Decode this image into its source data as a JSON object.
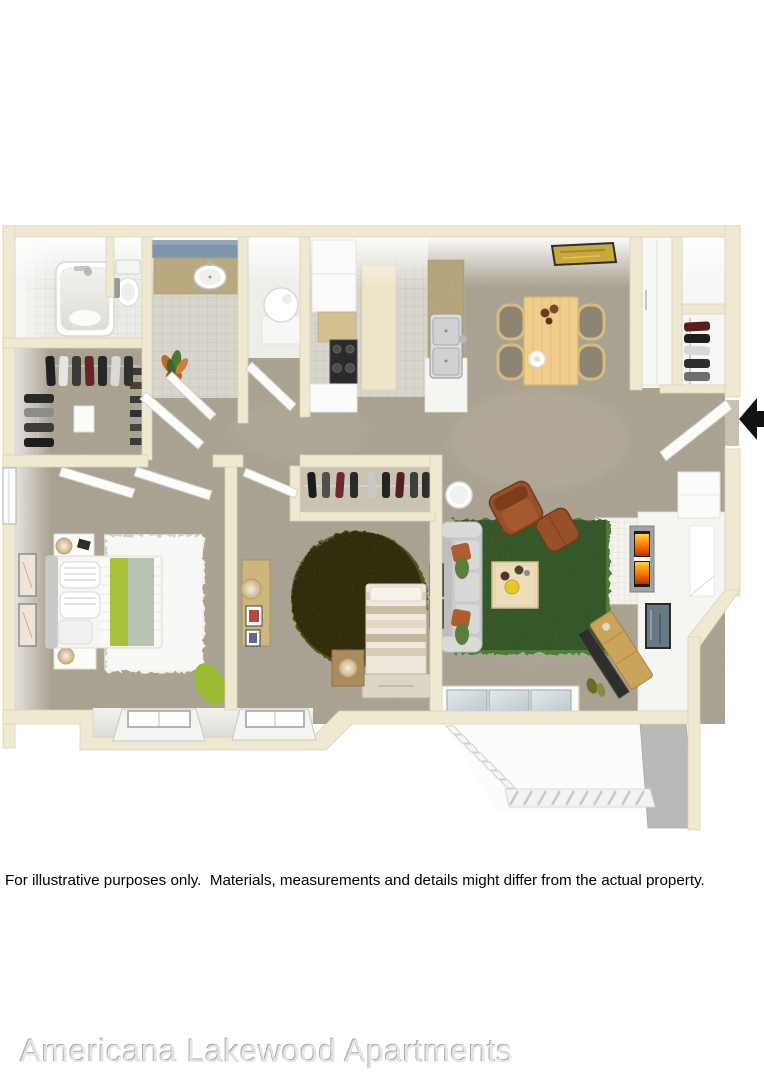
{
  "page": {
    "disclaimer": "For illustrative purposes only.  Materials, measurements and details might differ from the actual property.",
    "watermark": "Americana Lakewood Apartments"
  },
  "floorplan": {
    "description": "3D top-down rendering of a two-bedroom two-bathroom apartment floor plan with patio",
    "entry_arrow_icon": "solid black left-pointing arrow marking the front door",
    "rooms": [
      {
        "name": "master-bathroom",
        "features": [
          "bathtub",
          "toilet",
          "towel"
        ]
      },
      {
        "name": "walk-in-closet",
        "features": [
          "hanging-clothes",
          "clothes-rod",
          "dresser",
          "shoe-row"
        ]
      },
      {
        "name": "second-bathroom",
        "features": [
          "vanity-sink",
          "blue-accent-wall",
          "tile-floor",
          "potted-plant"
        ]
      },
      {
        "name": "utility-closet",
        "features": [
          "water-heater"
        ]
      },
      {
        "name": "kitchen",
        "features": [
          "refrigerator",
          "stove",
          "cabinets",
          "breakfast-bar",
          "double-sink",
          "runner-rug"
        ]
      },
      {
        "name": "dining-area",
        "features": [
          "dining-table",
          "four-chairs",
          "wall-art",
          "pantry-doors"
        ]
      },
      {
        "name": "entry",
        "features": [
          "front-door",
          "coat-closet",
          "shelf",
          "bench"
        ]
      },
      {
        "name": "master-bedroom",
        "features": [
          "bed",
          "two-nightstands",
          "lamps",
          "white-shag-rug",
          "wall-art",
          "window",
          "floor-cushion"
        ]
      },
      {
        "name": "bedroom-2",
        "features": [
          "bed",
          "foot-chest",
          "round-olive-rug",
          "desk",
          "lamp",
          "closet-with-clothes",
          "nightstand",
          "wall-art",
          "window"
        ]
      },
      {
        "name": "living-room",
        "features": [
          "sofa",
          "armchair",
          "ottoman",
          "coffee-table",
          "green-shag-rug",
          "side-table",
          "fireplace",
          "tv-console",
          "wall-art",
          "sliding-glass-door",
          "window-niche"
        ]
      },
      {
        "name": "patio",
        "features": [
          "railing",
          "privacy-wall"
        ]
      }
    ]
  },
  "colors": {
    "background": "#ffffff",
    "wall": "#f0e9d2",
    "wall_edge": "#d9d2b4",
    "wall_face": "#f5f5f2",
    "carpet": "#b9b09e",
    "carpet_light": "#c9c1b0",
    "tile": "#d8d5cc",
    "tile_line": "#c3c0b6",
    "counter_granite": "#d3c091",
    "cabinet_white": "#fbfbfa",
    "rug_living_green": "#4e7c3a",
    "rug_bedroom_olive": "#5a5316",
    "rug_master_white": "#f2f1ed",
    "sofa_gray": "#cccccc",
    "armchair_brown": "#96502a",
    "pillow_rust": "#b05c2c",
    "wood_light": "#f0cd8c",
    "wood_mid": "#c9a45a",
    "bed_accent_green": "#a9c23b",
    "bed_accent_sage": "#b8c2b1",
    "stove_black": "#2b2b2b",
    "bath_wall_blue": "#7e95ab",
    "patio_wall_gray": "#b9b9b9",
    "entry_arrow_black": "#111111",
    "text_black": "#000000",
    "watermark_gray": "#e4e4e4"
  }
}
